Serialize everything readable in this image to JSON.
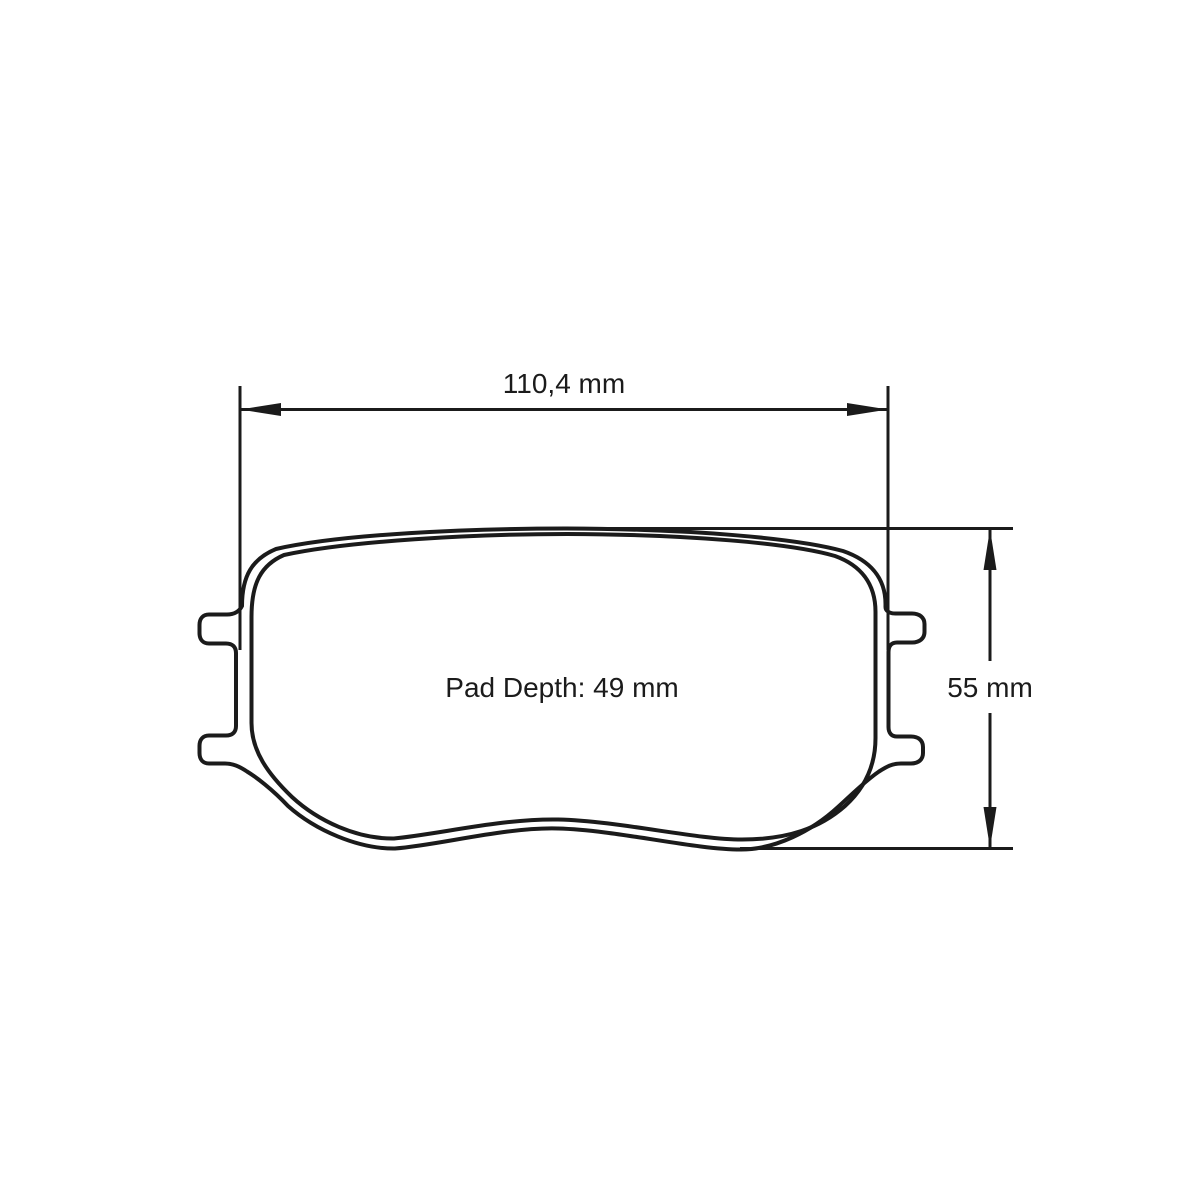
{
  "page": {
    "background": "#ffffff"
  },
  "diagram": {
    "type": "brake-pad-technical-drawing",
    "line_color": "#1b1b1b",
    "text_color": "#1b1b1b",
    "labels": {
      "width": "110,4 mm",
      "height": "55 mm",
      "pad_depth": "Pad Depth: 49 mm"
    },
    "values": {
      "width_mm": 110.4,
      "height_mm": 55,
      "pad_depth_mm": 49,
      "units": "mm"
    }
  }
}
